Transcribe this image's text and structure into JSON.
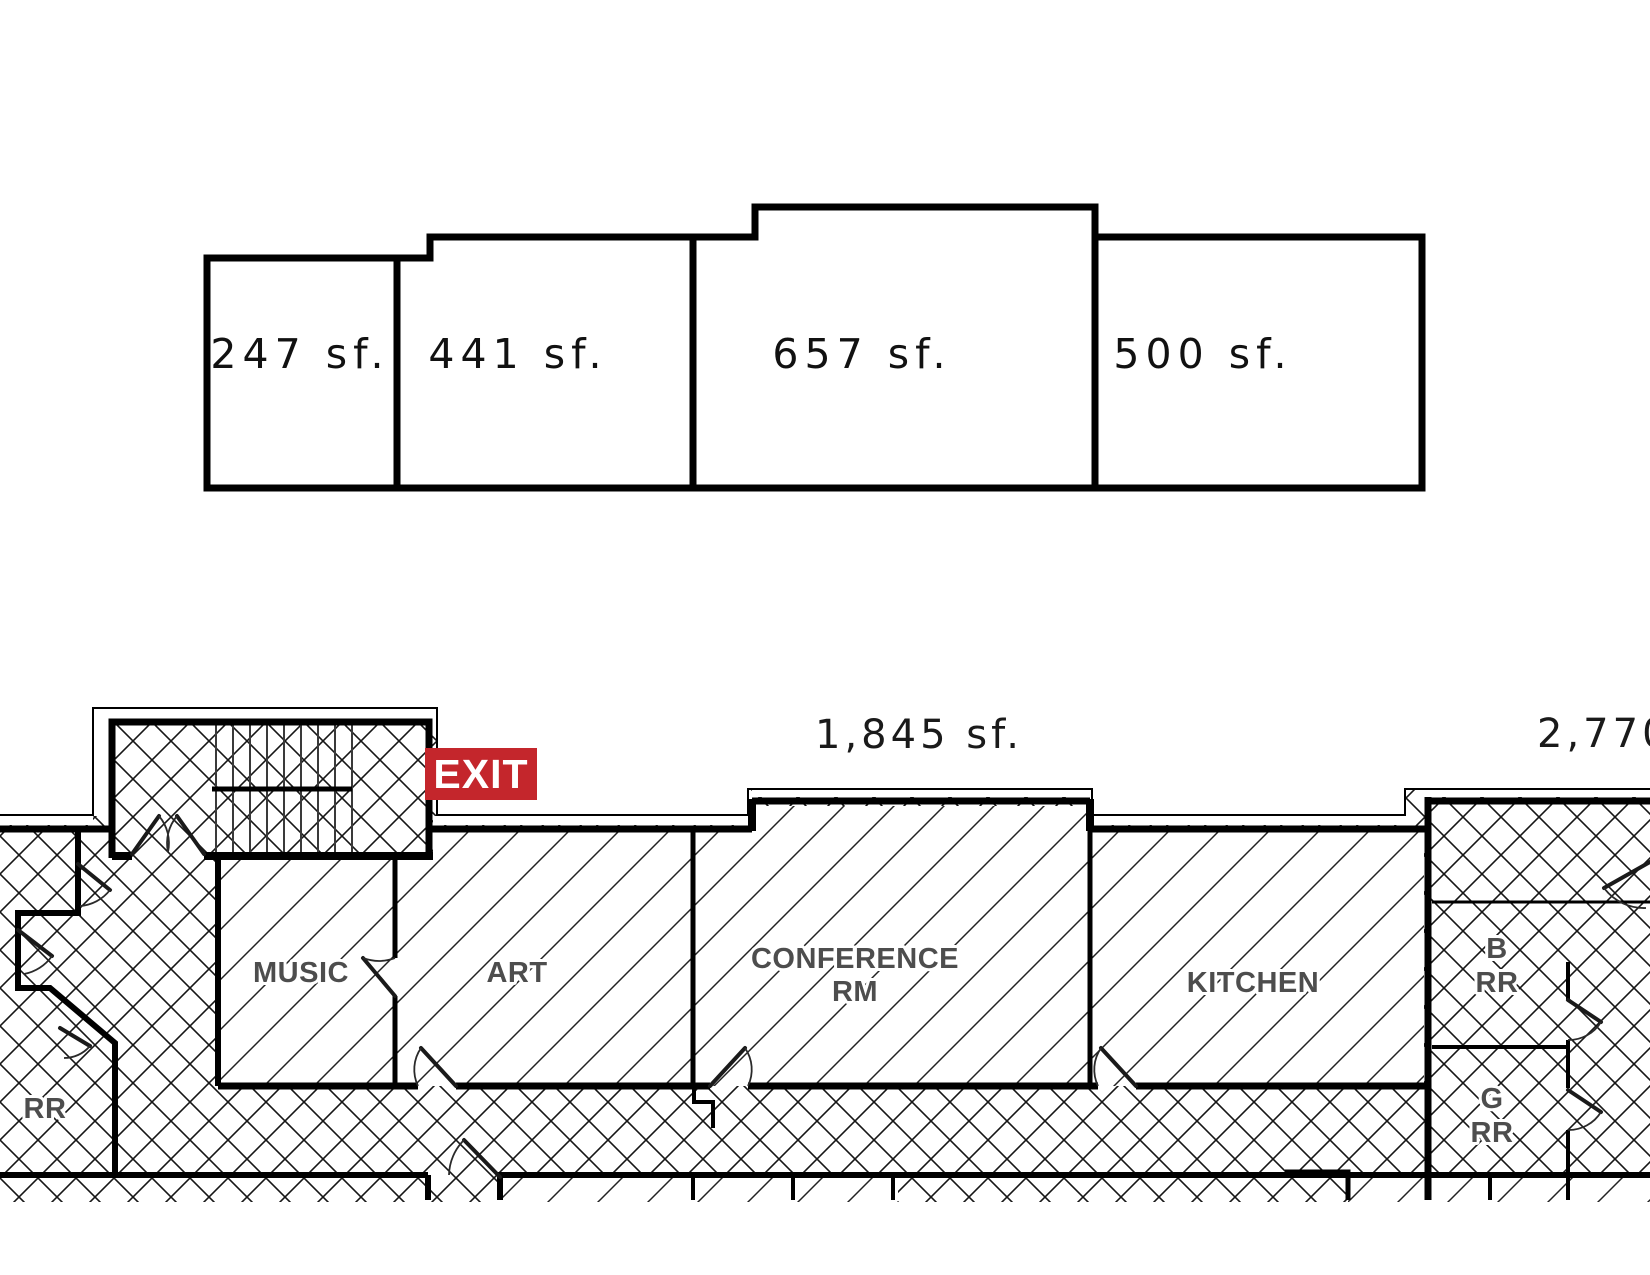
{
  "page": {
    "width": 1650,
    "height": 1275,
    "background": "#ffffff"
  },
  "top_diagram": {
    "suites": [
      {
        "name": "suite-1",
        "area_label": "247 sf."
      },
      {
        "name": "suite-2",
        "area_label": "441 sf."
      },
      {
        "name": "suite-3",
        "area_label": "657 sf."
      },
      {
        "name": "suite-4",
        "area_label": "500 sf."
      }
    ]
  },
  "floor_plan": {
    "area_labels": {
      "center_suite": "1,845 sf.",
      "right_suite": "2,770"
    },
    "exit_sign": {
      "label": "EXIT",
      "background_color": "#c4262c",
      "text_color": "#ffffff"
    },
    "room_labels": {
      "music": "MUSIC",
      "art": "ART",
      "conference_line1": "CONFERENCE",
      "conference_line2": "RM",
      "kitchen": "KITCHEN",
      "b_rr_line1": "B",
      "b_rr_line2": "RR",
      "g_rr_line1": "G",
      "g_rr_line2": "RR",
      "left_rr": "RR"
    },
    "colors": {
      "wall": "#000000",
      "room_label": "#4d4d4d",
      "area_text": "#1a1a1a",
      "exit_red": "#c4262c"
    }
  }
}
